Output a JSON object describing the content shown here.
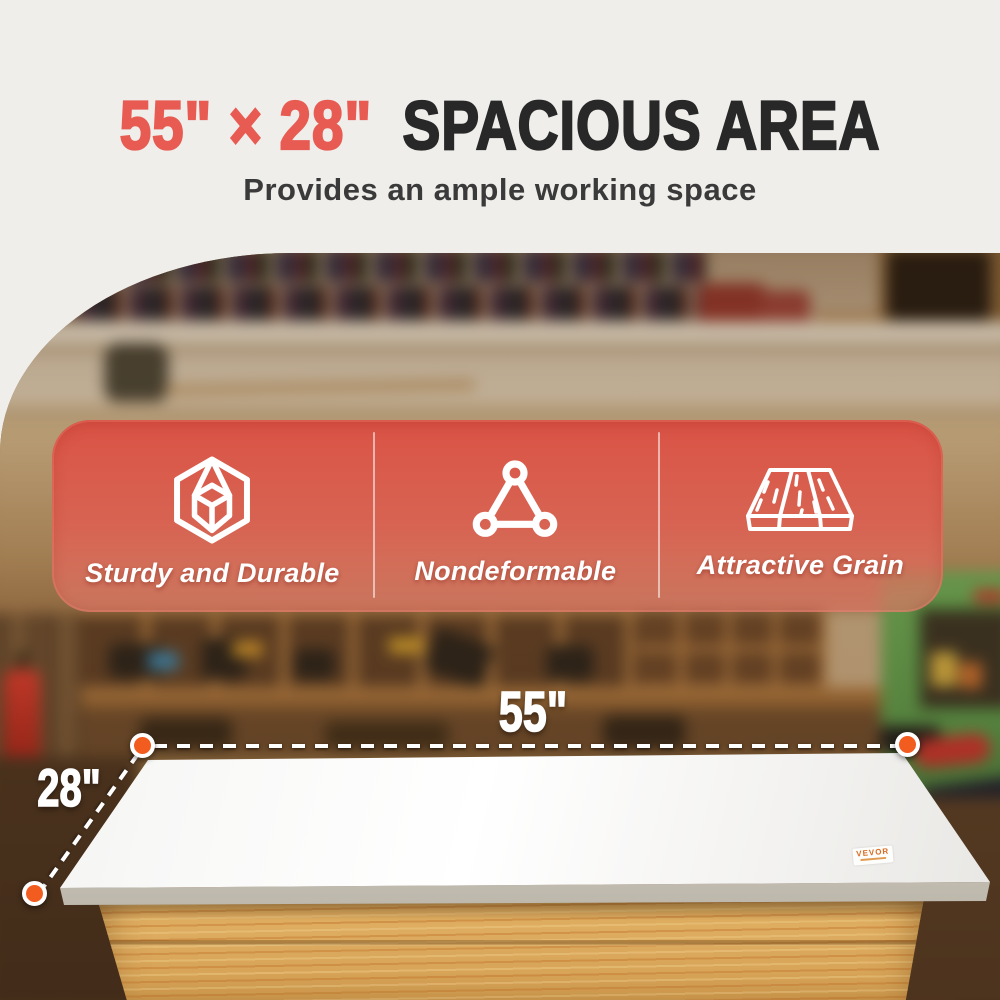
{
  "headline": {
    "dimensions": "55\" × 28\"",
    "title": "SPACIOUS AREA",
    "subtitle": "Provides an ample working space"
  },
  "features": [
    {
      "icon": "cube-icon",
      "label": "Sturdy and Durable"
    },
    {
      "icon": "triangle-nodes-icon",
      "label": "Nondeformable"
    },
    {
      "icon": "wood-plank-icon",
      "label": "Attractive Grain"
    }
  ],
  "dimensions": {
    "width_label": "55\"",
    "depth_label": "28\""
  },
  "brand": "VEVOR",
  "colors": {
    "accent_red": "#E85B52",
    "title_dark": "#282828",
    "banner_red": "#DF4D42",
    "marker_orange": "#F25C1E",
    "wood": "#DCAA5E",
    "green_wall": "#5D9447"
  }
}
